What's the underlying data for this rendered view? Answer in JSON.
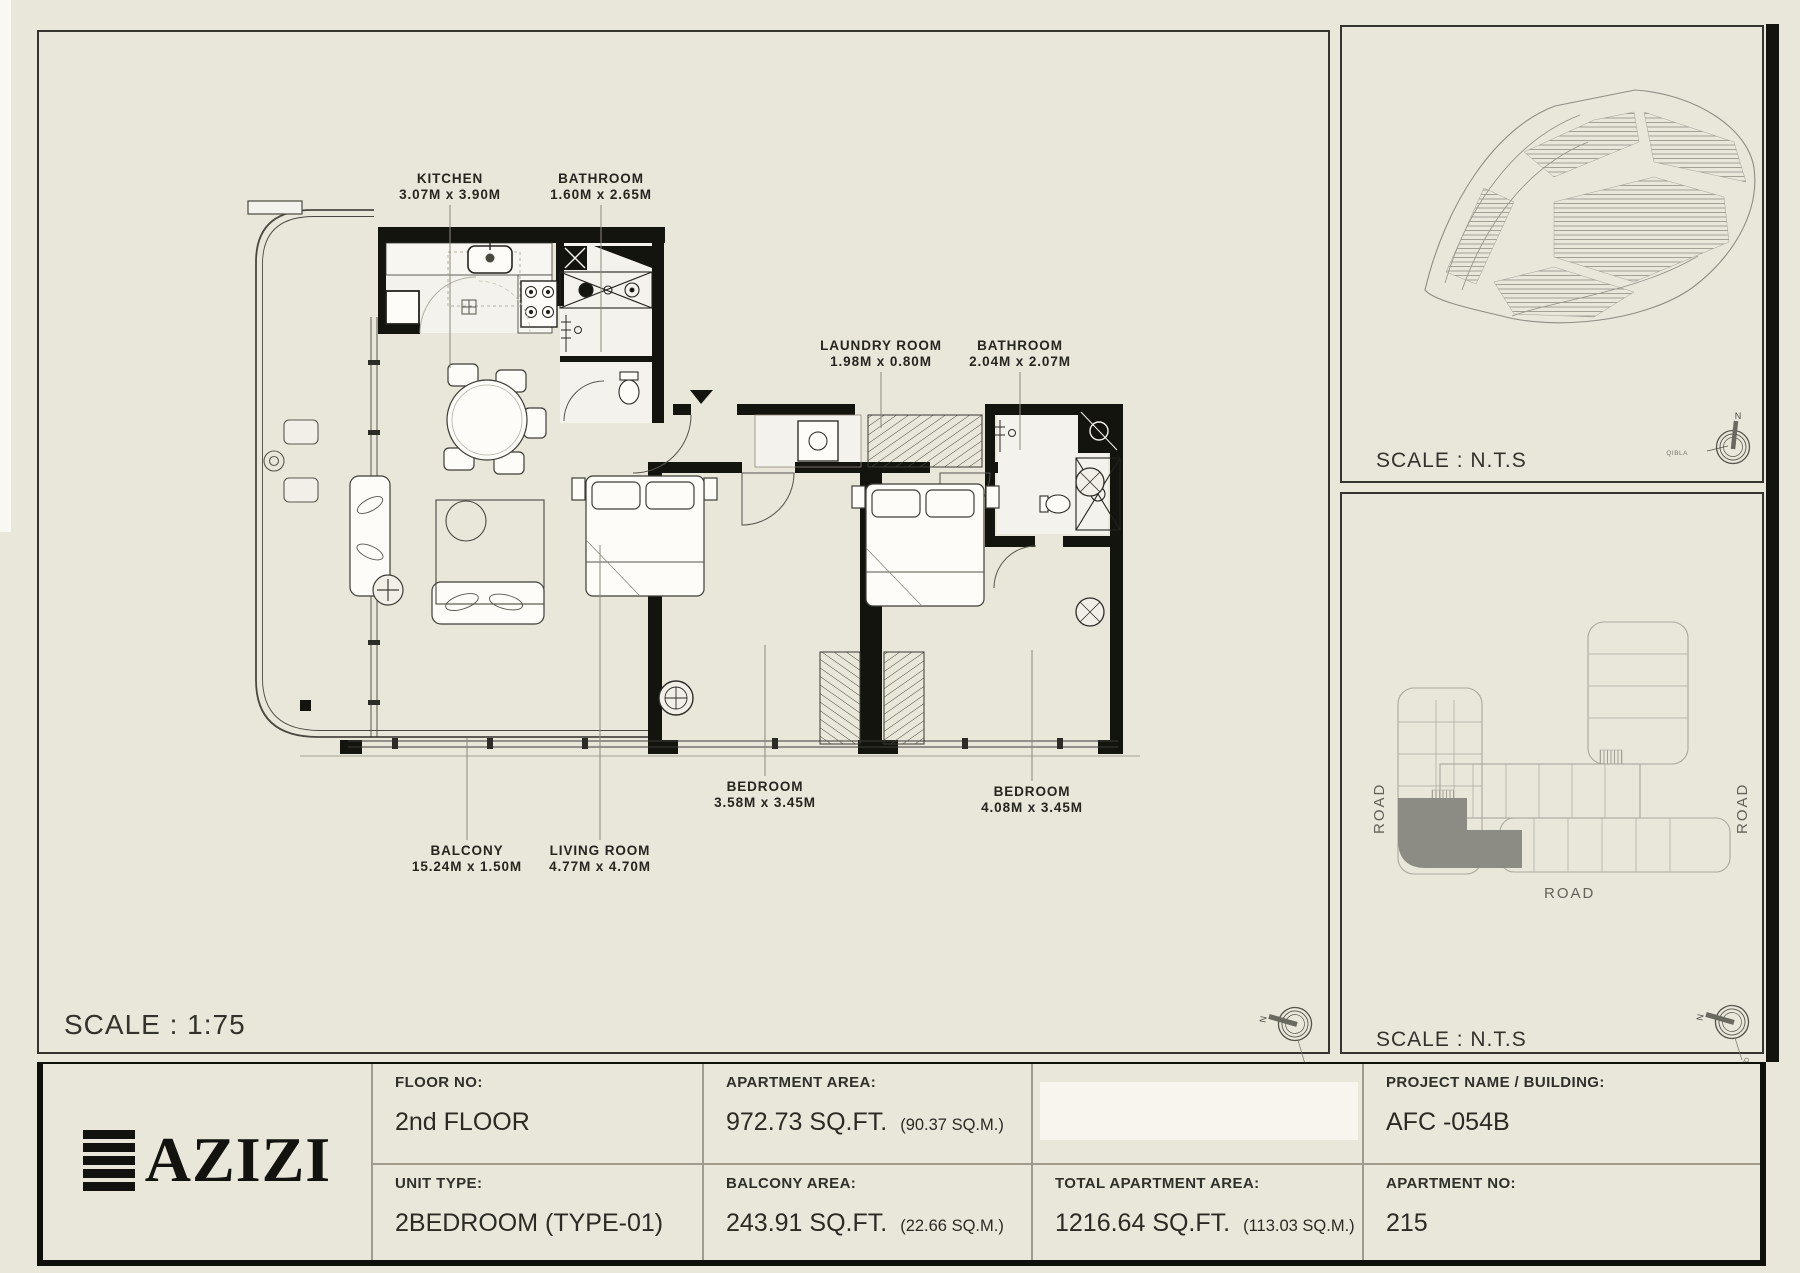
{
  "colors": {
    "paper": "#e9e6da",
    "ink": "#14140f",
    "drawing_gray": "#aaa99e",
    "highlight_gray": "#8d8c84"
  },
  "main_plan": {
    "scale_label": "SCALE : 1:75",
    "north_label": "N",
    "qibla_label": "QIBLA",
    "rooms": [
      {
        "id": "kitchen",
        "name": "KITCHEN",
        "dims": "3.07M x 3.90M"
      },
      {
        "id": "bathroom-1",
        "name": "BATHROOM",
        "dims": "1.60M x 2.65M"
      },
      {
        "id": "laundry",
        "name": "LAUNDRY ROOM",
        "dims": "1.98M x 0.80M"
      },
      {
        "id": "bathroom-2",
        "name": "BATHROOM",
        "dims": "2.04M x 2.07M"
      },
      {
        "id": "bedroom-1",
        "name": "BEDROOM",
        "dims": "3.58M x 3.45M"
      },
      {
        "id": "bedroom-2",
        "name": "BEDROOM",
        "dims": "4.08M x 3.45M"
      },
      {
        "id": "balcony",
        "name": "BALCONY",
        "dims": "15.24M x 1.50M"
      },
      {
        "id": "living",
        "name": "LIVING ROOM",
        "dims": "4.77M x 4.70M"
      }
    ]
  },
  "site_panel": {
    "scale_label": "SCALE : N.T.S",
    "north_label": "N",
    "qibla_label": "QIBLA"
  },
  "building_panel": {
    "scale_label": "SCALE : N.T.S",
    "road_left": "ROAD",
    "road_right": "ROAD",
    "road_bottom": "ROAD",
    "north_label": "N",
    "qibla_label": "QIBLA"
  },
  "info_table": {
    "brand": "AZIZI",
    "floor_label": "FLOOR NO:",
    "floor_value": "2nd FLOOR",
    "unit_type_label": "UNIT TYPE:",
    "unit_type_value": "2BEDROOM (TYPE-01)",
    "apartment_area_label": "APARTMENT AREA:",
    "apartment_area_value": "972.73 SQ.FT.",
    "apartment_area_metric": "(90.37 SQ.M.)",
    "balcony_area_label": "BALCONY AREA:",
    "balcony_area_value": "243.91 SQ.FT.",
    "balcony_area_metric": "(22.66 SQ.M.)",
    "total_area_label": "TOTAL APARTMENT AREA:",
    "total_area_value": "1216.64 SQ.FT.",
    "total_area_metric": "(113.03 SQ.M.)",
    "project_label": "PROJECT NAME / BUILDING:",
    "project_value": "AFC -054B",
    "apartment_no_label": "APARTMENT NO:",
    "apartment_no_value": "215"
  }
}
